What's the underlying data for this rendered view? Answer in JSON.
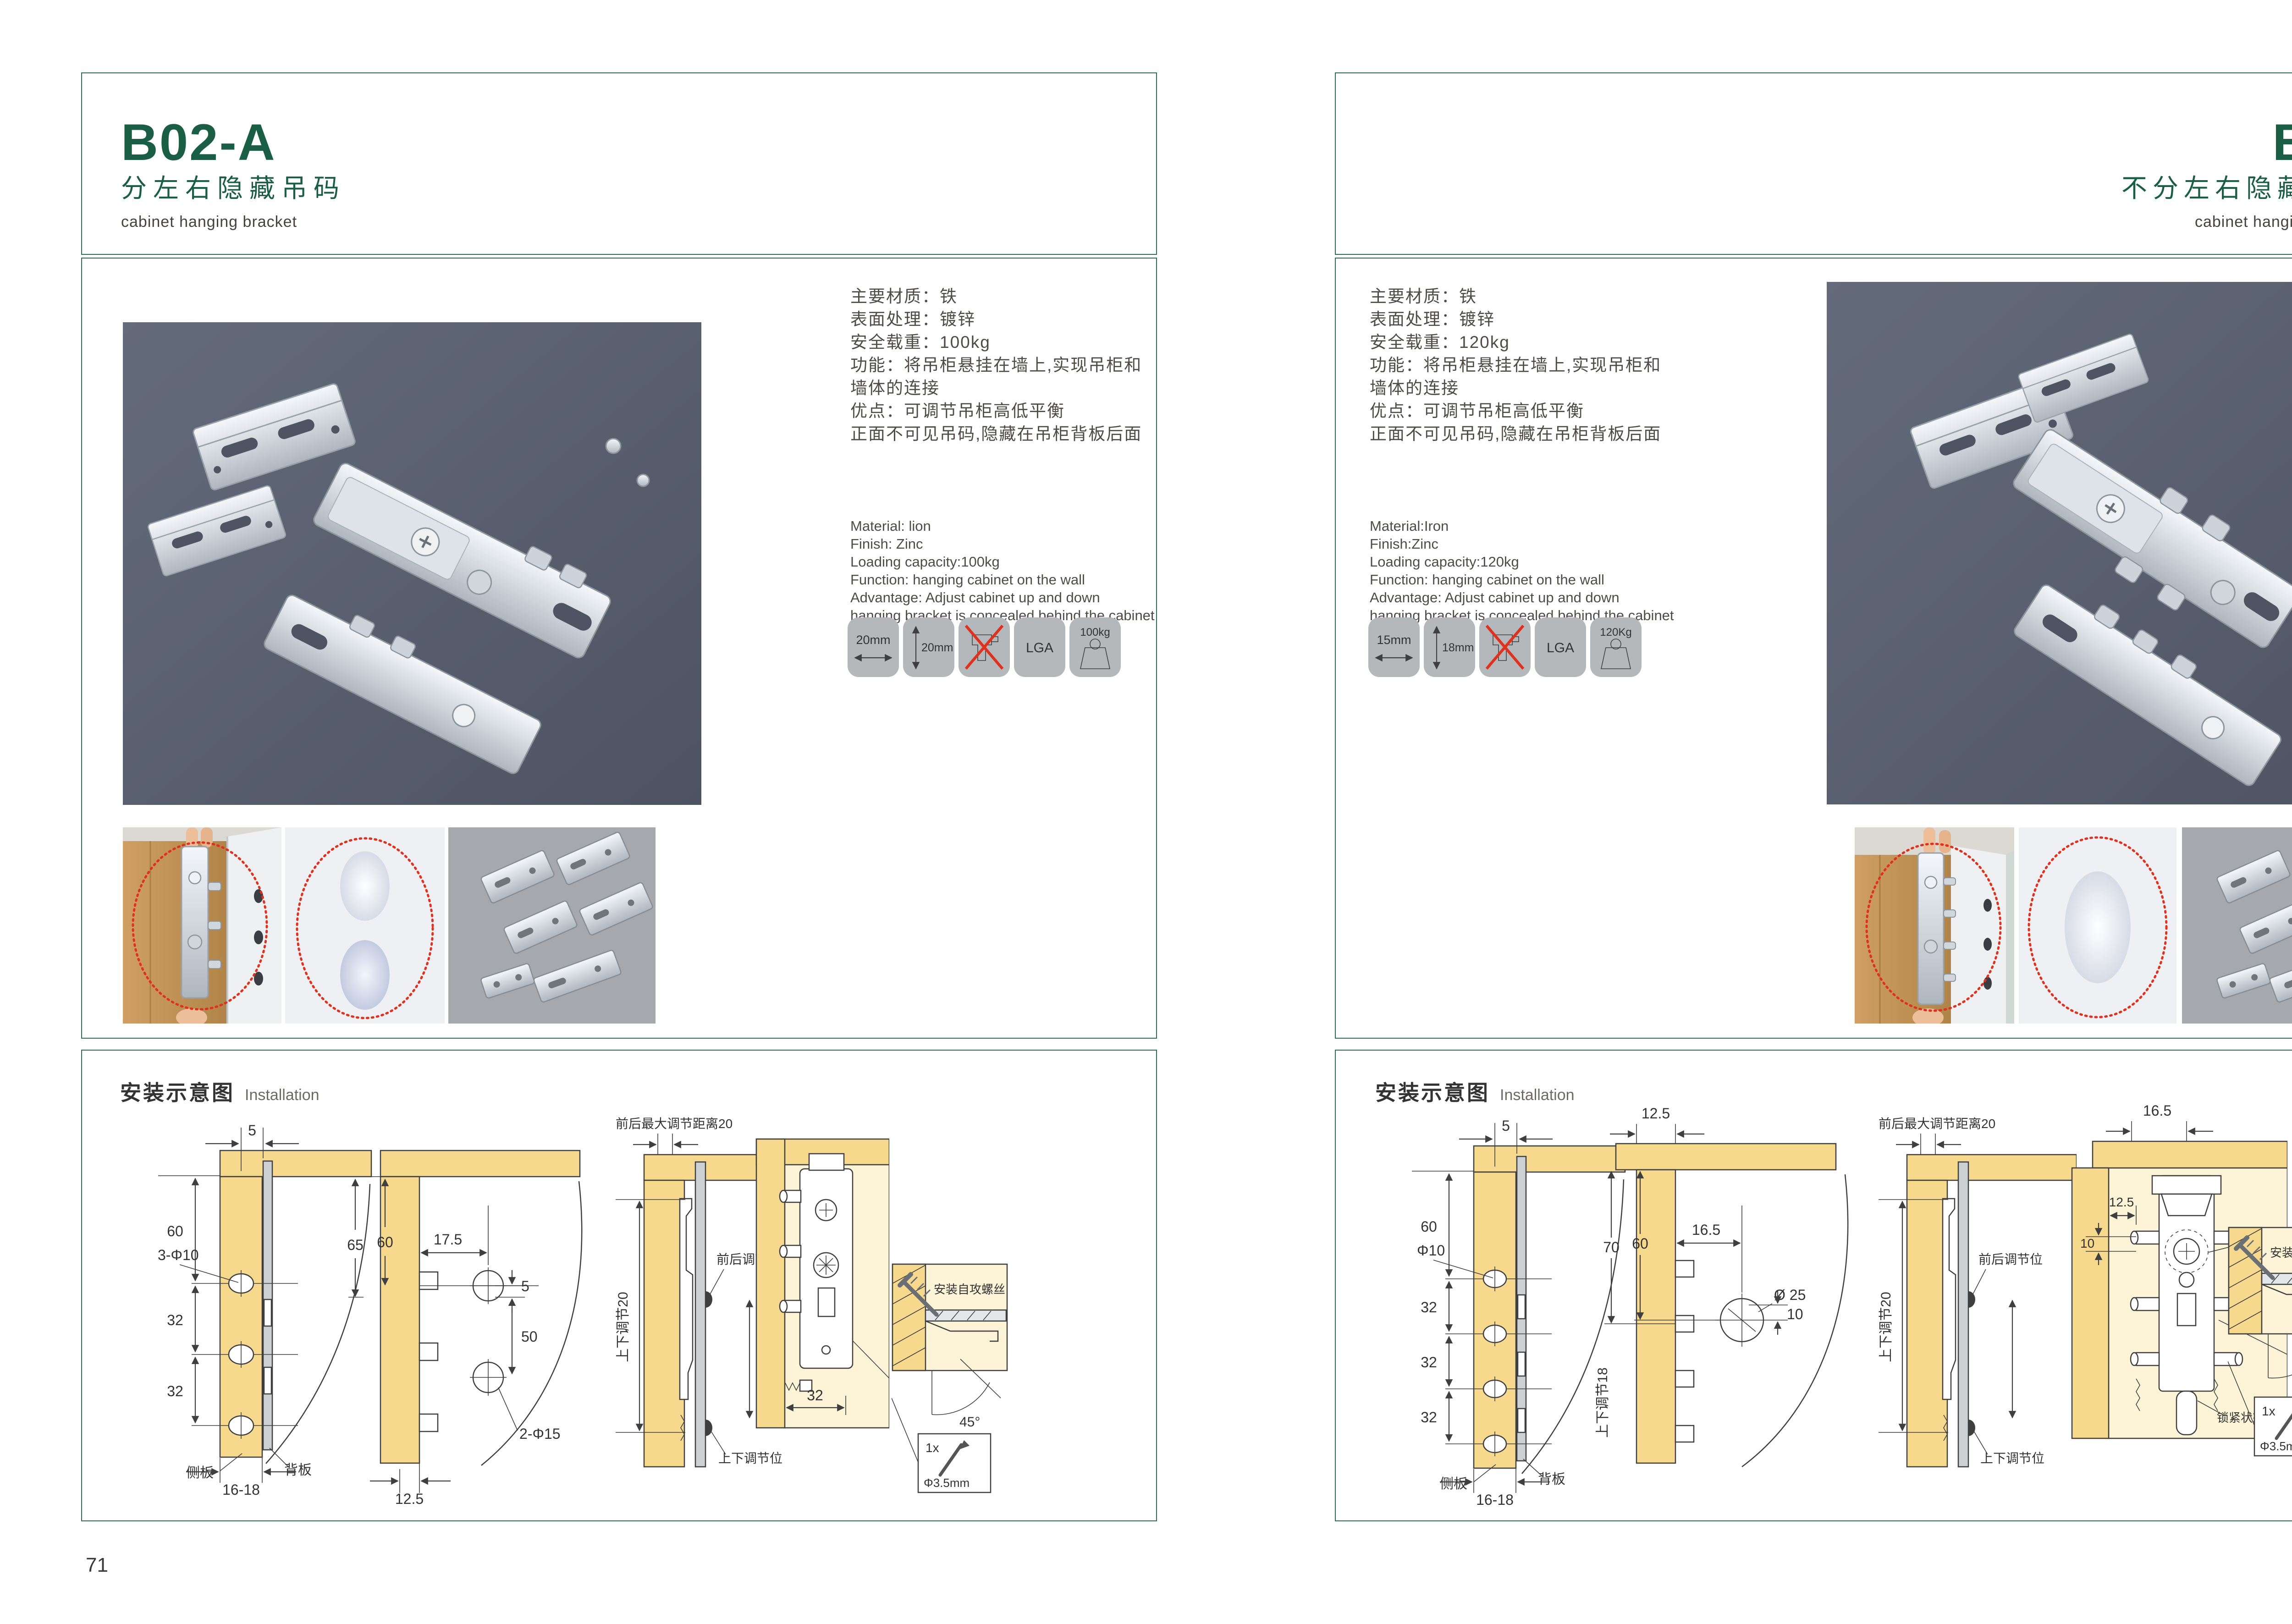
{
  "theme": {
    "green": "#1a5f45",
    "border": "#2f6c59",
    "red": "#e0301e",
    "wood": "#f7d98e",
    "wood_pale": "#fdf3d6",
    "panel_gray": "#cdd0d2",
    "photo_bg": "#5a6070",
    "tile_bg": "#b4b8bb",
    "thumb_gray": "#a5a9ad"
  },
  "page_left": {
    "code": "B02-A",
    "title_cn": "分左右隐藏吊码",
    "title_en": "cabinet hanging bracket",
    "page_number": "71",
    "specs_cn": [
      "主要材质：铁",
      "表面处理：镀锌",
      "安全载重：100kg",
      "功能：将吊柜悬挂在墙上,实现吊柜和",
      "墙体的连接",
      "优点：可调节吊柜高低平衡",
      "正面不可见吊码,隐藏在吊柜背板后面"
    ],
    "specs_en": [
      "Material: lion",
      "Finish: Zinc",
      "Loading capacity:100kg",
      "Function: hanging cabinet on the wall",
      "Advantage: Adjust cabinet up and down",
      "hanging bracket is concealed behind the cabinet"
    ],
    "icons": {
      "width": "20mm",
      "height": "20mm",
      "cert": "LGA",
      "capacity": "100kg"
    },
    "install": {
      "header_cn": "安装示意图",
      "header_en": "Installation",
      "d1": {
        "top": "5",
        "h60": "60",
        "hole": "3-Φ10",
        "s1": "32",
        "s2": "32",
        "side": "侧板",
        "back": "背板",
        "bottom": "16-18"
      },
      "d2": {
        "l65": "65",
        "l60": "60",
        "w175": "17.5",
        "g5": "5",
        "v50": "50",
        "hole": "2-Φ15",
        "bottom": "12.5"
      },
      "d3": {
        "top": "前后最大调节距离20",
        "rot": "上下调节20",
        "front": "前后调节位",
        "updown": "上下调节位"
      },
      "d4": {
        "dim": "32"
      },
      "d5": {
        "label": "安装自攻螺丝",
        "angle": "45°",
        "qty": "1x",
        "dia": "Φ3.5mm"
      }
    }
  },
  "page_right": {
    "code": "B03",
    "title_cn": "不分左右隐藏吊码",
    "title_en": "cabinet hanging bracket",
    "page_number": "72",
    "specs_cn": [
      "主要材质：铁",
      "表面处理：镀锌",
      "安全载重：120kg",
      "功能：将吊柜悬挂在墙上,实现吊柜和",
      "墙体的连接",
      "优点：可调节吊柜高低平衡",
      "正面不可见吊码,隐藏在吊柜背板后面"
    ],
    "specs_en": [
      "Material:Iron",
      "Finish:Zinc",
      "Loading capacity:120kg",
      "Function: hanging cabinet on the wall",
      "Advantage: Adjust cabinet up and down",
      "hanging bracket is concealed behind the cabinet"
    ],
    "icons": {
      "width": "15mm",
      "height": "18mm",
      "cert": "LGA",
      "capacity": "120Kg"
    },
    "install": {
      "header_cn": "安装示意图",
      "header_en": "Installation",
      "d1": {
        "top": "5",
        "h60": "60",
        "hole": "Φ10",
        "s1": "32",
        "s2": "32",
        "s3": "32",
        "side": "侧板",
        "back": "背板",
        "bottom": "16-18"
      },
      "d2": {
        "top": "12.5",
        "l70": "70",
        "l60": "60",
        "w165": "16.5",
        "hole": "Ø 25",
        "off": "10",
        "rot": "上下调节18"
      },
      "d3": {
        "top": "前后最大调节距离20",
        "rot": "上下调节20",
        "front": "前后调节位",
        "updown": "上下调节位"
      },
      "d4": {
        "top": "16.5",
        "w125": "12.5",
        "off": "10",
        "hole": "ø25",
        "lock": "锁紧状态"
      },
      "d5": {
        "label": "安装自攻螺丝",
        "angle": "45°",
        "qty": "1x",
        "dia": "Φ3.5mm"
      }
    }
  }
}
